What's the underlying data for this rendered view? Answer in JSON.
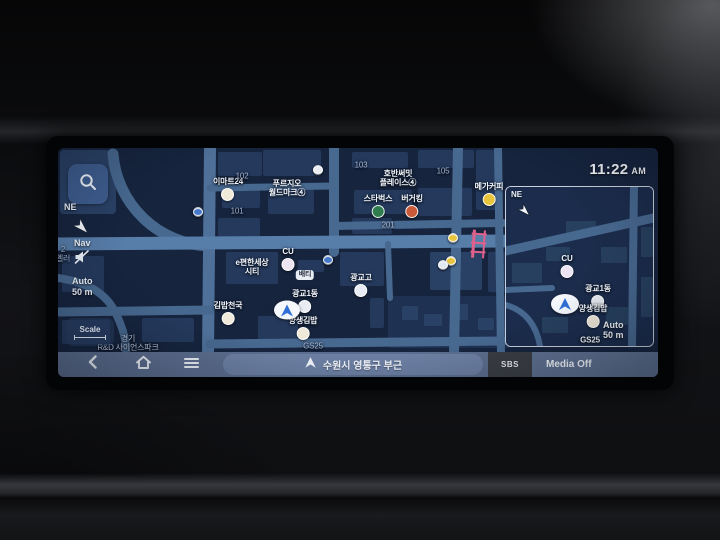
{
  "clock": {
    "time": "11:22",
    "meridiem": "AM"
  },
  "controls": {
    "compass": "NE",
    "nav": "Nav",
    "auto_line1": "Auto",
    "auto_line2": "50 m",
    "scale": "Scale"
  },
  "bottom_bar": {
    "back_icon": "chevron-left",
    "home_icon": "home",
    "menu_icon": "hamburger",
    "location": "수원시 영통구 부근",
    "media_source": "SBS",
    "media_status": "Media Off"
  },
  "map": {
    "pois": [
      {
        "id": "emart24",
        "type": "poi",
        "label": "이마트24",
        "x": 170,
        "y": 41,
        "color": "#efe9d8"
      },
      {
        "id": "prugio-worldmark",
        "type": "label",
        "label": "푸르지오\n월드마크④",
        "x": 229,
        "y": 40
      },
      {
        "id": "bldg-102",
        "type": "num",
        "label": "102",
        "x": 184,
        "y": 28
      },
      {
        "id": "bldg-101",
        "type": "num",
        "label": "101",
        "x": 179,
        "y": 63
      },
      {
        "id": "bldg-103",
        "type": "num",
        "label": "103",
        "x": 303,
        "y": 17
      },
      {
        "id": "bldg-105",
        "type": "num",
        "label": "105",
        "x": 385,
        "y": 23
      },
      {
        "id": "hoban-summit",
        "type": "label",
        "label": "호반써밋\n플레이스④",
        "x": 340,
        "y": 30
      },
      {
        "id": "starbucks",
        "type": "poi",
        "label": "스타벅스",
        "x": 320,
        "y": 58,
        "color": "#2f7d4f"
      },
      {
        "id": "burgerking",
        "type": "poi",
        "label": "버거킹",
        "x": 354,
        "y": 58,
        "color": "#c95a3a"
      },
      {
        "id": "bldg-201",
        "type": "num",
        "label": "201",
        "x": 330,
        "y": 77
      },
      {
        "id": "mega-coffee",
        "type": "poi",
        "label": "메가커피",
        "x": 431,
        "y": 46,
        "color": "#e7c53d"
      },
      {
        "id": "cu",
        "type": "poi",
        "label": "CU",
        "x": 230,
        "y": 111,
        "color": "#ece4f2"
      },
      {
        "id": "baeti",
        "type": "pill",
        "label": "배티",
        "x": 247,
        "y": 127
      },
      {
        "id": "epyeonhansesang-city",
        "type": "label",
        "label": "e편한세상\n시티",
        "x": 194,
        "y": 119
      },
      {
        "id": "gwanggyo-high",
        "type": "poi",
        "label": "광교고",
        "x": 303,
        "y": 137,
        "color": "#e9edf3"
      },
      {
        "id": "gwanggyo-1dong",
        "type": "poi",
        "label": "광교1동",
        "x": 247,
        "y": 153,
        "color": "#e9edf3"
      },
      {
        "id": "kimbap-cheonguk",
        "type": "poi",
        "label": "김밥천국",
        "x": 170,
        "y": 165,
        "color": "#f0e8d9"
      },
      {
        "id": "yangsaeng-kimbap",
        "type": "poi",
        "label": "양생김밥",
        "x": 245,
        "y": 180,
        "color": "#f0e8d9"
      },
      {
        "id": "gs25",
        "type": "num",
        "label": "GS25",
        "x": 255,
        "y": 198
      },
      {
        "id": "gyeonggi-rnd-park",
        "type": "area",
        "label": "경기\nR&D 사이언스파크",
        "x": 70,
        "y": 195
      },
      {
        "id": "edge-label",
        "type": "num",
        "label": "2\n벨러",
        "x": 5,
        "y": 106
      },
      {
        "id": "info-dot-1",
        "type": "dot",
        "label": "",
        "x": 140,
        "y": 64,
        "color": "#4779c8"
      },
      {
        "id": "info-dot-2",
        "type": "dot",
        "label": "",
        "x": 270,
        "y": 112,
        "color": "#4779c8"
      },
      {
        "id": "poi-dot",
        "type": "dot",
        "label": "",
        "x": 260,
        "y": 22,
        "color": "#e9edf3"
      },
      {
        "id": "camera-1",
        "type": "dot",
        "label": "",
        "x": 395,
        "y": 90,
        "color": "#e7c53d"
      },
      {
        "id": "camera-2",
        "type": "dot",
        "label": "",
        "x": 393,
        "y": 113,
        "color": "#e7c53d"
      },
      {
        "id": "white-marker",
        "type": "dot",
        "label": "",
        "x": 385,
        "y": 117,
        "color": "#dfe7f0"
      }
    ]
  },
  "minimap": {
    "compass": "NE",
    "auto_line1": "Auto",
    "auto_line2": "50 m",
    "pois": [
      {
        "id": "mini-cu",
        "type": "poi",
        "label": "CU",
        "x": 61,
        "y": 79,
        "color": "#ece4f2"
      },
      {
        "id": "mini-gwanggyo-1dong",
        "type": "poi",
        "label": "광교1동",
        "x": 92,
        "y": 109,
        "color": "#e9edf3"
      },
      {
        "id": "mini-yangsaeng-kimbap",
        "type": "poi",
        "label": "양생김밥",
        "x": 87,
        "y": 129,
        "color": "#f0e8d9"
      },
      {
        "id": "mini-gs25",
        "type": "label",
        "label": "GS25",
        "x": 84,
        "y": 153
      }
    ]
  }
}
